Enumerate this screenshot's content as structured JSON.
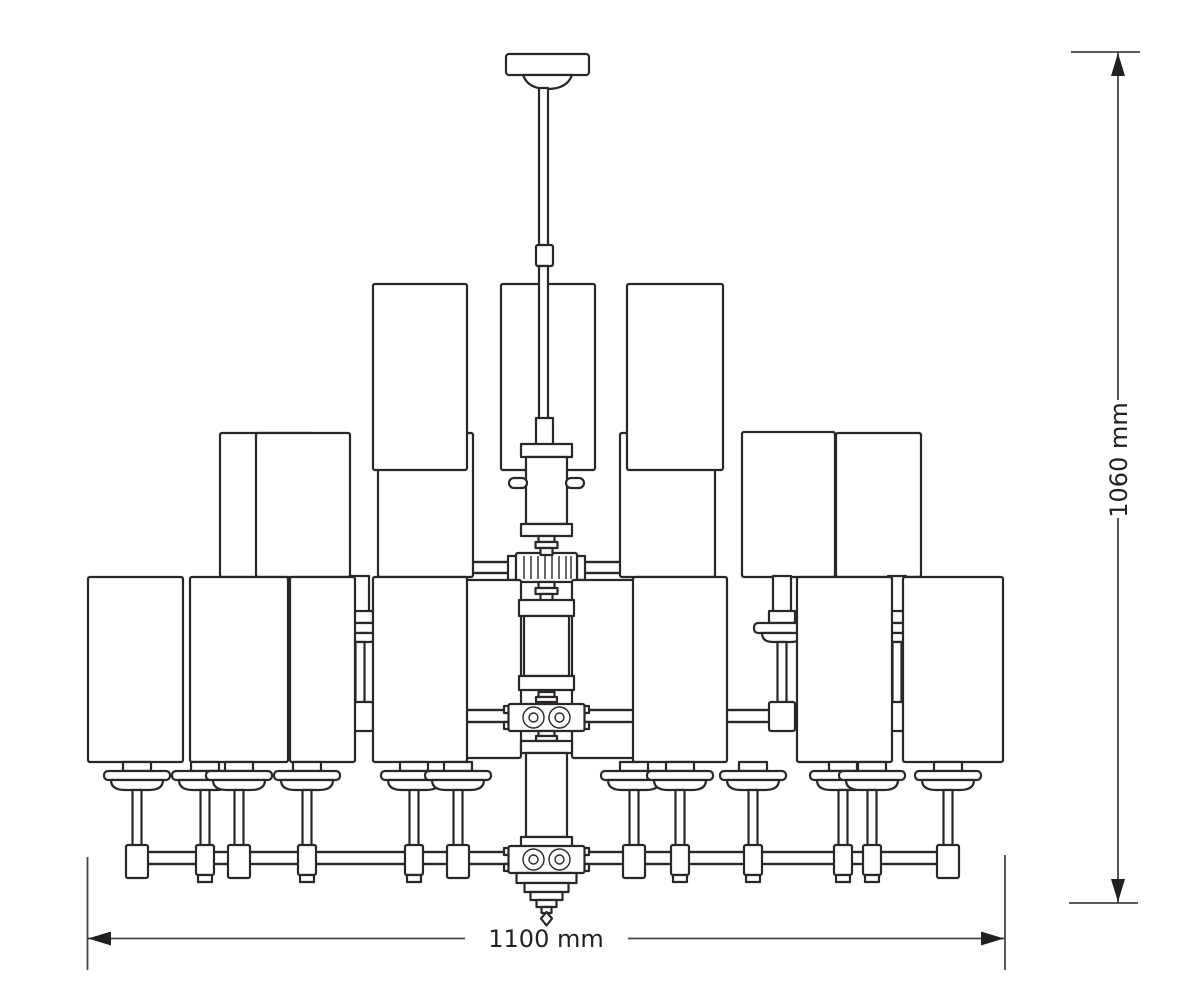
{
  "page": {
    "background": "#ffffff"
  },
  "drawing": {
    "subject": "Chandelier front-view dimensional drawing",
    "line_color": "#2b2627",
    "dimension_text_color": "#231f20",
    "width_dimension": {
      "label": "1100 mm"
    },
    "height_dimension": {
      "label": "1060 mm"
    },
    "shade_tiers": {
      "top": 3,
      "middle": 6,
      "bottom": 9
    },
    "visible_candles": {
      "bottom_tier": 12,
      "middle_tier": 3
    }
  }
}
